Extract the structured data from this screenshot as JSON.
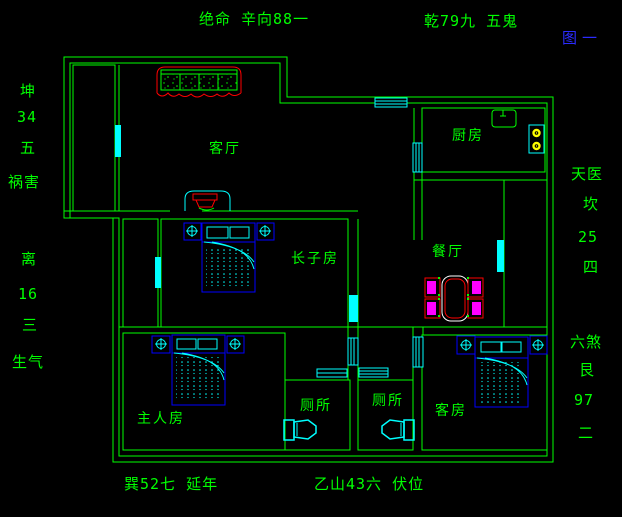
{
  "annotations": {
    "top_left": "绝命 辛向88一",
    "top_right": "乾79九 五鬼",
    "figure_label": "图一",
    "left_upper": [
      "坤",
      "34",
      "五",
      "祸害"
    ],
    "left_lower": [
      "离",
      "16",
      "三",
      "生气"
    ],
    "right_upper": [
      "天医",
      "坎",
      "25",
      "四"
    ],
    "right_lower": [
      "六煞",
      "艮",
      "97",
      "二"
    ],
    "bottom_left": "巽52七 延年",
    "bottom_center": "乙山43六 伏位"
  },
  "rooms": {
    "living": "客厅",
    "kitchen": "厨房",
    "dining": "餐厅",
    "eldest_son": "长子房",
    "master": "主人房",
    "toilet_left": "厕所",
    "toilet_right": "厕所",
    "guest": "客房"
  },
  "colors": {
    "background": "#000000",
    "wall_green": "#00ff00",
    "window_cyan": "#00ffff",
    "furniture_blue": "#0000ff",
    "accent_red": "#ff0000",
    "chair_magenta": "#ff00ff",
    "burner_yellow": "#ffff00",
    "table_white": "#ffffff",
    "figure_blue": "#2b2bff"
  }
}
